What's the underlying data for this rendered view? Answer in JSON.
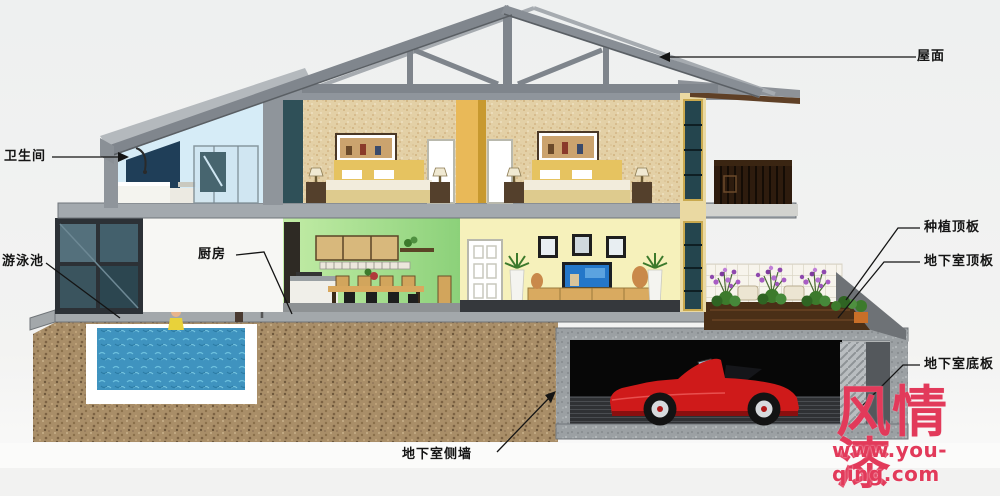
{
  "callouts": {
    "roof": "屋面",
    "bathroom": "卫生间",
    "swimming_pool": "游泳池",
    "kitchen": "厨房",
    "planting_roof_slab": "种植顶板",
    "basement_roof_slab": "地下室顶板",
    "basement_floor_slab": "地下室底板",
    "basement_side_wall": "地下室侧墙"
  },
  "watermark": {
    "brand": "风情漆",
    "url": "www.you-qing.com",
    "color": "#e23a5a"
  },
  "palette": {
    "background": "#f2f2f1",
    "roof_gray": "#80868d",
    "soil_brown": "#a98e68",
    "pool_water": "#3f93bf",
    "kitchen_wall_green": "#a8e08e",
    "living_wall_yellow": "#f6f1bb",
    "bedroom_wallpaper": "#e3d0a6",
    "facade_cream": "#ead9a2",
    "car_red": "#cf1a1a",
    "label_text": "#141414"
  }
}
